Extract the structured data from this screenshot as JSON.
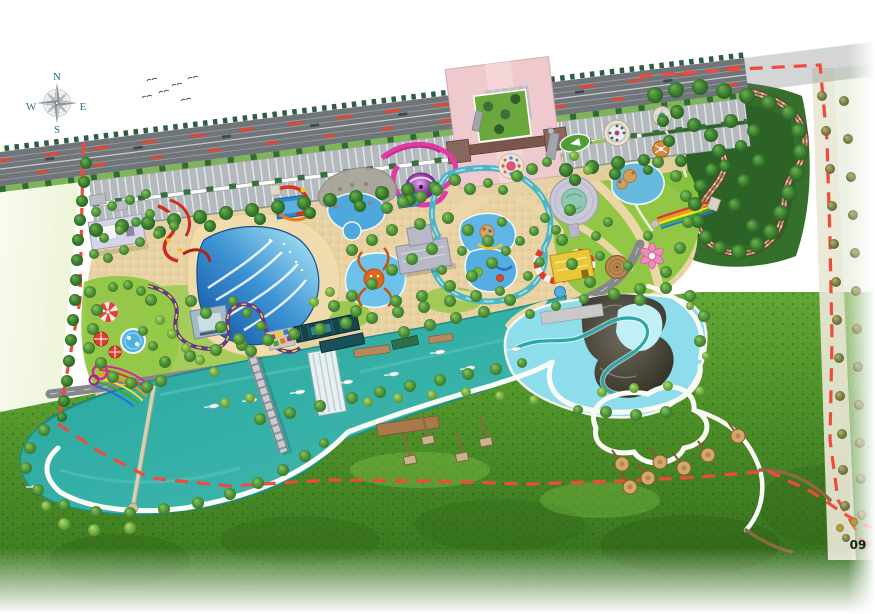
{
  "compass": {
    "north": "N",
    "east": "E",
    "south": "S",
    "west": "W"
  },
  "sheet": {
    "page_number": "09"
  },
  "palette": {
    "boundary_red": "#ef4b3c",
    "river_teal": "#2ba9a1",
    "lagoon_blue": "#8edded",
    "wave_pool_blue": "#3c92d2",
    "sand": "#e8d2a3",
    "lawn_green": "#8cc63f",
    "meadow_green": "#4e9129",
    "forest_green": "#3a7d2e",
    "road_gray": "#70757a",
    "parking_gray": "#b4b9bd",
    "plaza_pink": "#eec9cd",
    "track_brown": "#6d3a2e",
    "slide_pink": "#e23aa4",
    "slide_red": "#cf2b20",
    "coaster_purple": "#5d3a8e",
    "compass_text": "#26707d"
  },
  "map": {
    "vegetation": {
      "dark": [
        [
          96,
          230,
          7
        ],
        [
          122,
          226,
          7
        ],
        [
          148,
          223,
          7
        ],
        [
          174,
          220,
          7
        ],
        [
          200,
          217,
          7
        ],
        [
          226,
          213,
          7
        ],
        [
          252,
          210,
          7
        ],
        [
          278,
          207,
          7
        ],
        [
          304,
          203,
          7
        ],
        [
          330,
          200,
          7
        ],
        [
          356,
          197,
          7
        ],
        [
          382,
          193,
          7
        ],
        [
          408,
          190,
          7
        ],
        [
          434,
          187,
          6
        ],
        [
          566,
          170,
          7
        ],
        [
          592,
          167,
          7
        ],
        [
          618,
          163,
          7
        ],
        [
          644,
          160,
          6
        ],
        [
          160,
          232,
          6
        ],
        [
          210,
          226,
          6
        ],
        [
          260,
          219,
          6
        ],
        [
          310,
          213,
          6
        ],
        [
          360,
          206,
          6
        ],
        [
          410,
          200,
          6
        ],
        [
          575,
          180,
          6
        ],
        [
          615,
          174,
          6
        ],
        [
          648,
          170,
          5
        ],
        [
          86,
          163,
          6
        ],
        [
          84,
          182,
          6
        ],
        [
          82,
          201,
          6
        ],
        [
          80,
          220,
          6
        ],
        [
          78,
          240,
          6
        ],
        [
          77,
          260,
          6
        ],
        [
          76,
          280,
          6
        ],
        [
          75,
          300,
          6
        ],
        [
          73,
          320,
          6
        ],
        [
          71,
          340,
          6
        ],
        [
          69,
          361,
          6
        ],
        [
          67,
          381,
          6
        ],
        [
          64,
          401,
          6
        ],
        [
          62,
          417,
          5
        ],
        [
          655,
          95,
          8
        ],
        [
          676,
          90,
          8
        ],
        [
          700,
          87,
          8
        ],
        [
          724,
          91,
          8
        ],
        [
          747,
          96,
          8
        ],
        [
          769,
          103,
          8
        ],
        [
          789,
          113,
          8
        ],
        [
          799,
          131,
          8
        ],
        [
          801,
          152,
          8
        ],
        [
          797,
          173,
          8
        ],
        [
          789,
          193,
          8
        ],
        [
          781,
          213,
          8
        ],
        [
          771,
          232,
          8
        ],
        [
          757,
          245,
          8
        ],
        [
          739,
          252,
          8
        ],
        [
          720,
          248,
          7
        ],
        [
          706,
          237,
          7
        ],
        [
          698,
          221,
          7
        ],
        [
          695,
          204,
          7
        ],
        [
          701,
          186,
          7
        ],
        [
          712,
          170,
          7
        ],
        [
          719,
          151,
          7
        ],
        [
          711,
          135,
          7
        ],
        [
          694,
          125,
          7
        ],
        [
          677,
          112,
          7
        ],
        [
          663,
          121,
          6
        ],
        [
          669,
          141,
          6
        ],
        [
          681,
          161,
          6
        ],
        [
          731,
          121,
          7
        ],
        [
          754,
          131,
          7
        ],
        [
          759,
          161,
          7
        ],
        [
          744,
          181,
          7
        ],
        [
          735,
          205,
          7
        ],
        [
          753,
          226,
          7
        ],
        [
          725,
          166,
          6
        ],
        [
          741,
          146,
          6
        ]
      ],
      "mid": [
        [
          165,
          362,
          6
        ],
        [
          190,
          356,
          6
        ],
        [
          216,
          350,
          6
        ],
        [
          242,
          345,
          6
        ],
        [
          268,
          340,
          6
        ],
        [
          294,
          334,
          6
        ],
        [
          320,
          329,
          6
        ],
        [
          346,
          323,
          6
        ],
        [
          372,
          318,
          6
        ],
        [
          398,
          312,
          6
        ],
        [
          424,
          307,
          6
        ],
        [
          450,
          301,
          6
        ],
        [
          476,
          296,
          6
        ],
        [
          500,
          291,
          5
        ],
        [
          352,
          398,
          6
        ],
        [
          380,
          392,
          6
        ],
        [
          410,
          386,
          6
        ],
        [
          440,
          380,
          6
        ],
        [
          468,
          374,
          6
        ],
        [
          496,
          369,
          6
        ],
        [
          522,
          363,
          5
        ],
        [
          320,
          406,
          6
        ],
        [
          290,
          413,
          6
        ],
        [
          260,
          419,
          6
        ],
        [
          44,
          430,
          6
        ],
        [
          30,
          448,
          6
        ],
        [
          26,
          468,
          6
        ],
        [
          38,
          490,
          6
        ],
        [
          64,
          505,
          6
        ],
        [
          96,
          512,
          6
        ],
        [
          130,
          513,
          6
        ],
        [
          164,
          509,
          6
        ],
        [
          198,
          503,
          6
        ],
        [
          230,
          494,
          6
        ],
        [
          258,
          483,
          6
        ],
        [
          283,
          470,
          6
        ],
        [
          305,
          456,
          6
        ],
        [
          324,
          443,
          5
        ],
        [
          530,
          314,
          5
        ],
        [
          556,
          306,
          5
        ],
        [
          584,
          299,
          5
        ],
        [
          640,
          289,
          6
        ],
        [
          666,
          288,
          6
        ],
        [
          690,
          296,
          6
        ],
        [
          704,
          316,
          6
        ],
        [
          700,
          341,
          6
        ],
        [
          666,
          412,
          6
        ],
        [
          636,
          415,
          6
        ],
        [
          606,
          412,
          6
        ],
        [
          578,
          410,
          5
        ],
        [
          352,
          250,
          6
        ],
        [
          372,
          240,
          6
        ],
        [
          392,
          230,
          6
        ],
        [
          420,
          224,
          6
        ],
        [
          448,
          218,
          6
        ],
        [
          468,
          230,
          6
        ],
        [
          488,
          241,
          6
        ],
        [
          432,
          249,
          6
        ],
        [
          412,
          259,
          6
        ],
        [
          392,
          270,
          6
        ],
        [
          372,
          284,
          6
        ],
        [
          352,
          296,
          6
        ],
        [
          334,
          306,
          6
        ],
        [
          356,
          311,
          6
        ],
        [
          396,
          301,
          6
        ],
        [
          422,
          296,
          6
        ],
        [
          450,
          286,
          6
        ],
        [
          472,
          276,
          6
        ],
        [
          492,
          263,
          6
        ],
        [
          506,
          251,
          5
        ],
        [
          520,
          241,
          5
        ],
        [
          534,
          231,
          5
        ],
        [
          502,
          222,
          5
        ],
        [
          462,
          251,
          5
        ],
        [
          442,
          270,
          5
        ],
        [
          510,
          300,
          6
        ],
        [
          484,
          312,
          6
        ],
        [
          456,
          318,
          6
        ],
        [
          430,
          325,
          6
        ],
        [
          404,
          332,
          6
        ],
        [
          90,
          292,
          6
        ],
        [
          97,
          310,
          6
        ],
        [
          93,
          329,
          6
        ],
        [
          89,
          348,
          6
        ],
        [
          101,
          363,
          6
        ],
        [
          113,
          377,
          6
        ],
        [
          131,
          383,
          6
        ],
        [
          147,
          387,
          6
        ],
        [
          161,
          381,
          6
        ],
        [
          151,
          300,
          6
        ],
        [
          141,
          291,
          5
        ],
        [
          128,
          285,
          5
        ],
        [
          113,
          287,
          5
        ],
        [
          143,
          331,
          5
        ],
        [
          153,
          346,
          5
        ],
        [
          165,
          361,
          5
        ],
        [
          191,
          301,
          6
        ],
        [
          206,
          313,
          6
        ],
        [
          221,
          327,
          6
        ],
        [
          239,
          339,
          6
        ],
        [
          251,
          351,
          6
        ],
        [
          233,
          301,
          5
        ],
        [
          247,
          313,
          5
        ],
        [
          261,
          326,
          5
        ],
        [
          570,
          210,
          6
        ],
        [
          562,
          240,
          6
        ],
        [
          572,
          264,
          6
        ],
        [
          590,
          282,
          6
        ],
        [
          614,
          294,
          6
        ],
        [
          640,
          300,
          6
        ],
        [
          666,
          272,
          6
        ],
        [
          680,
          248,
          6
        ],
        [
          688,
          222,
          6
        ],
        [
          686,
          196,
          6
        ],
        [
          676,
          176,
          6
        ],
        [
          658,
          162,
          6
        ],
        [
          600,
          256,
          5
        ],
        [
          648,
          236,
          5
        ],
        [
          628,
          266,
          5
        ],
        [
          455,
          180,
          6
        ],
        [
          470,
          189,
          6
        ],
        [
          437,
          190,
          6
        ],
        [
          421,
          197,
          6
        ],
        [
          403,
          202,
          6
        ],
        [
          387,
          208,
          6
        ],
        [
          517,
          176,
          6
        ],
        [
          532,
          169,
          6
        ],
        [
          547,
          162,
          5
        ],
        [
          488,
          183,
          5
        ],
        [
          503,
          190,
          5
        ],
        [
          545,
          218,
          5
        ],
        [
          556,
          230,
          5
        ],
        [
          540,
          262,
          5
        ],
        [
          528,
          276,
          5
        ],
        [
          596,
          236,
          5
        ],
        [
          608,
          222,
          5
        ],
        [
          96,
          212,
          5
        ],
        [
          112,
          206,
          5
        ],
        [
          130,
          200,
          5
        ],
        [
          146,
          194,
          5
        ],
        [
          150,
          214,
          5
        ],
        [
          136,
          222,
          5
        ],
        [
          120,
          230,
          5
        ],
        [
          104,
          238,
          5
        ],
        [
          94,
          254,
          5
        ],
        [
          108,
          258,
          5
        ],
        [
          124,
          250,
          5
        ],
        [
          140,
          242,
          5
        ],
        [
          158,
          234,
          5
        ],
        [
          174,
          226,
          5
        ]
      ],
      "light": [
        [
          368,
          402,
          5
        ],
        [
          398,
          398,
          5
        ],
        [
          432,
          395,
          5
        ],
        [
          466,
          392,
          5
        ],
        [
          500,
          396,
          5
        ],
        [
          534,
          400,
          5
        ],
        [
          602,
          392,
          5
        ],
        [
          634,
          388,
          5
        ],
        [
          668,
          386,
          5
        ],
        [
          700,
          391,
          5
        ],
        [
          64,
          524,
          6
        ],
        [
          94,
          530,
          6
        ],
        [
          130,
          528,
          6
        ],
        [
          46,
          506,
          5
        ],
        [
          250,
          398,
          5
        ],
        [
          225,
          403,
          5
        ],
        [
          574,
          156,
          5
        ],
        [
          588,
          170,
          5
        ],
        [
          330,
          292,
          5
        ],
        [
          314,
          302,
          5
        ],
        [
          160,
          320,
          5
        ],
        [
          172,
          334,
          5
        ],
        [
          186,
          348,
          5
        ],
        [
          200,
          360,
          5
        ],
        [
          214,
          372,
          5
        ],
        [
          690,
          306,
          4
        ],
        [
          706,
          356,
          4
        ]
      ],
      "olive": [
        [
          822,
          96,
          5
        ],
        [
          844,
          101,
          5
        ],
        [
          826,
          131,
          5
        ],
        [
          848,
          139,
          5
        ],
        [
          830,
          169,
          5
        ],
        [
          851,
          177,
          5
        ],
        [
          832,
          206,
          5
        ],
        [
          853,
          215,
          5
        ],
        [
          834,
          244,
          5
        ],
        [
          855,
          253,
          5
        ],
        [
          836,
          282,
          5
        ],
        [
          856,
          291,
          5
        ],
        [
          837,
          320,
          5
        ],
        [
          857,
          329,
          5
        ],
        [
          839,
          358,
          5
        ],
        [
          858,
          367,
          5
        ],
        [
          840,
          396,
          5
        ],
        [
          859,
          405,
          5
        ],
        [
          842,
          434,
          5
        ],
        [
          860,
          443,
          5
        ],
        [
          843,
          470,
          5
        ],
        [
          861,
          479,
          5
        ],
        [
          845,
          506,
          5
        ],
        [
          862,
          515,
          5
        ],
        [
          846,
          538,
          4
        ],
        [
          863,
          546,
          4
        ]
      ]
    },
    "boats": [
      [
        214,
        406,
        -8
      ],
      [
        252,
        400,
        -8
      ],
      [
        300,
        392,
        -8
      ],
      [
        348,
        382,
        -8
      ],
      [
        394,
        374,
        -8
      ],
      [
        440,
        352,
        -8
      ],
      [
        470,
        368,
        -8
      ],
      [
        516,
        349,
        -6
      ],
      [
        36,
        487,
        0
      ]
    ],
    "huts": [
      [
        428,
        440
      ],
      [
        462,
        457
      ],
      [
        410,
        460
      ],
      [
        486,
        442
      ]
    ],
    "pads": [
      [
        622,
        464
      ],
      [
        648,
        478
      ],
      [
        660,
        462
      ],
      [
        684,
        468
      ],
      [
        708,
        455
      ],
      [
        738,
        436
      ],
      [
        630,
        487
      ]
    ],
    "birds": [
      [
        152,
        80
      ],
      [
        164,
        92
      ],
      [
        177,
        85
      ],
      [
        186,
        100
      ],
      [
        147,
        97
      ],
      [
        193,
        78
      ]
    ]
  }
}
